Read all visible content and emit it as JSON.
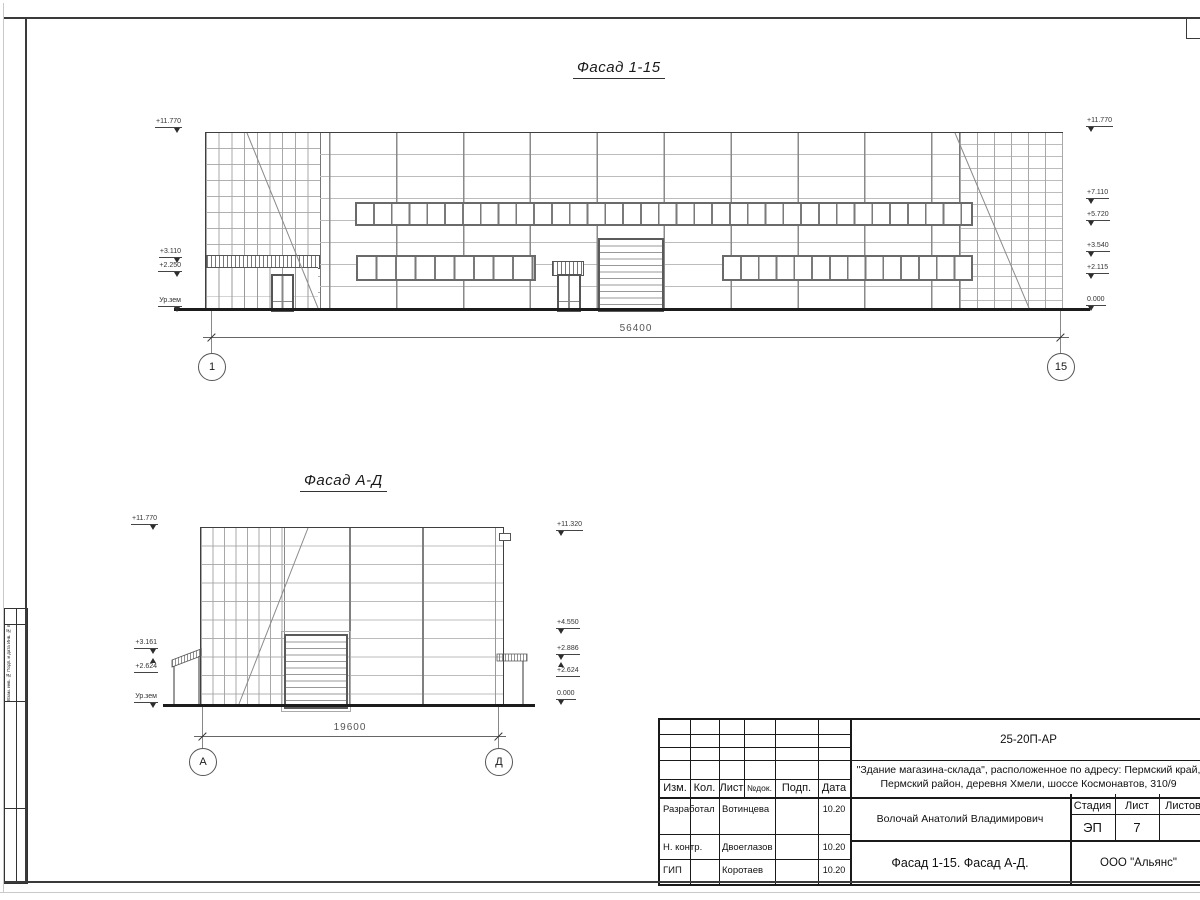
{
  "facade_1_15": {
    "title": "Фасад 1-15",
    "dimension": "56400",
    "axis_start": "1",
    "axis_end": "15",
    "marks_left": [
      "+11.770",
      "+3.110",
      "+2.250",
      "Ур.зем"
    ],
    "marks_right": [
      "+11.770",
      "+7.110",
      "+5.720",
      "+3.540",
      "+2.115",
      "0.000"
    ]
  },
  "facade_a_d": {
    "title": "Фасад А-Д",
    "dimension": "19600",
    "axis_start": "А",
    "axis_end": "Д",
    "marks_left": [
      "+11.770",
      "+3.161",
      "+2.624",
      "Ур.зем"
    ],
    "marks_right": [
      "+11.320",
      "+4.550",
      "+2.886",
      "+2.624",
      "0.000"
    ]
  },
  "title_block": {
    "doc_number": "25-20П-АР",
    "project_name_line1": "\"Здание магазина-склада\", расположенное по адресу: Пермский край,",
    "project_name_line2": "Пермский район, деревня Хмели, шоссе Космонавтов, 310/9",
    "columns": {
      "izm": "Изм.",
      "kol": "Кол.",
      "list": "Лист",
      "doc": "№док.",
      "sign": "Подп.",
      "date": "Дата"
    },
    "people": [
      {
        "role": "Разработал",
        "name": "Вотинцева",
        "date": "10.20"
      },
      {
        "role": "Н. контр.",
        "name": "Двоеглазов",
        "date": "10.20"
      },
      {
        "role": "ГИП",
        "name": "Коротаев",
        "date": "10.20"
      }
    ],
    "approver": "Волочай Анатолий Владимирович",
    "stage_label": "Стадия",
    "sheet_label": "Лист",
    "sheets_label": "Листов",
    "stage_value": "ЭП",
    "sheet_value": "7",
    "sheets_value": "",
    "drawing_title": "Фасад 1-15. Фасад А-Д.",
    "company": "ООО \"Альянс\""
  },
  "margin_strip": {
    "labels": "Взам. инв. №   Подп. и дата   Инв. № подл."
  }
}
